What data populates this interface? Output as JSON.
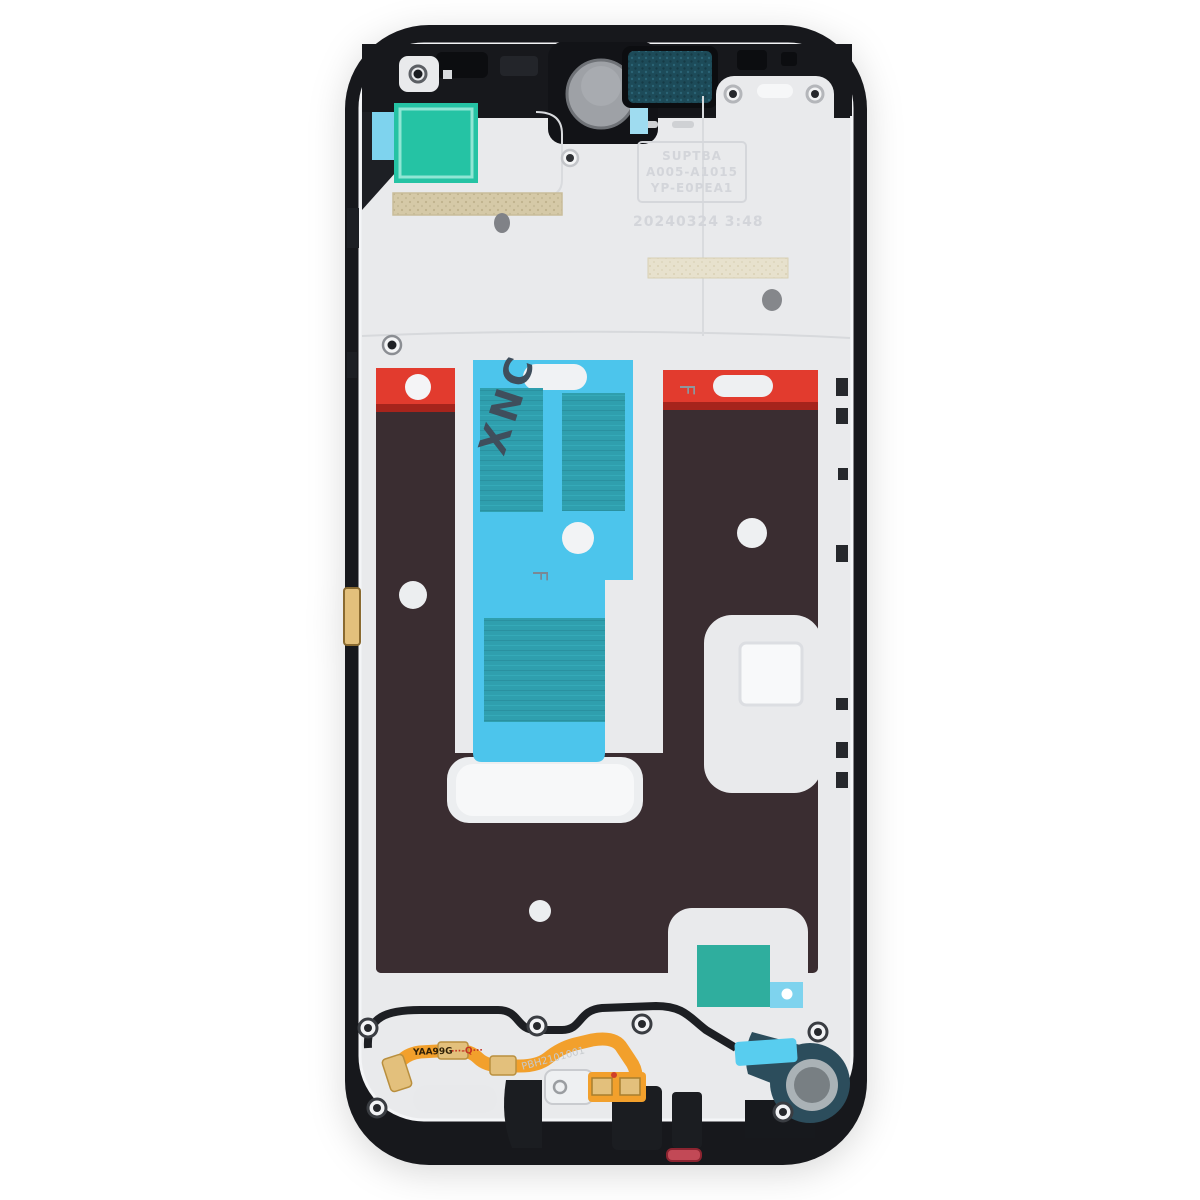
{
  "image": {
    "subject": "Smartphone middle frame / front housing bezel plate (rear view) on white background"
  },
  "markings": {
    "xnc": "XNC",
    "f_center": "F",
    "f_right": "F",
    "flex_code_prefix": "YAA99G",
    "flex_code_suffix": "···-Q···",
    "flex_serial": "PBH2101001",
    "embossed_line1": "SUPTBA",
    "embossed_line2": "A005-A1015",
    "embossed_line3": "YP-E0PEA1",
    "embossed_date": "20240324 3:48"
  },
  "colors": {
    "frame_black": "#17181c",
    "frame_black_soft": "#1d1f24",
    "plate_white": "#e9eaec",
    "plate_bright": "#f6f7f8",
    "panel_brown": "#3a2d31",
    "red_strip": "#e23b2e",
    "red_strip_dark": "#a6241c",
    "adhesive_cyan": "#4cc5ec",
    "adhesive_cyan_light": "#7ed3ee",
    "adhesive_teal": "#25c3a4",
    "adhesive_teal_dark": "#2f9fae",
    "mesh_tan": "#d5c9a7",
    "earpiece_teal": "#1d4b59",
    "gasket_teal": "#2c4d5c",
    "flex_orange": "#f2a02c",
    "pad_gold": "#e3c07c",
    "marking_ink": "#3f4e5c",
    "accent_red": "#c24956"
  }
}
